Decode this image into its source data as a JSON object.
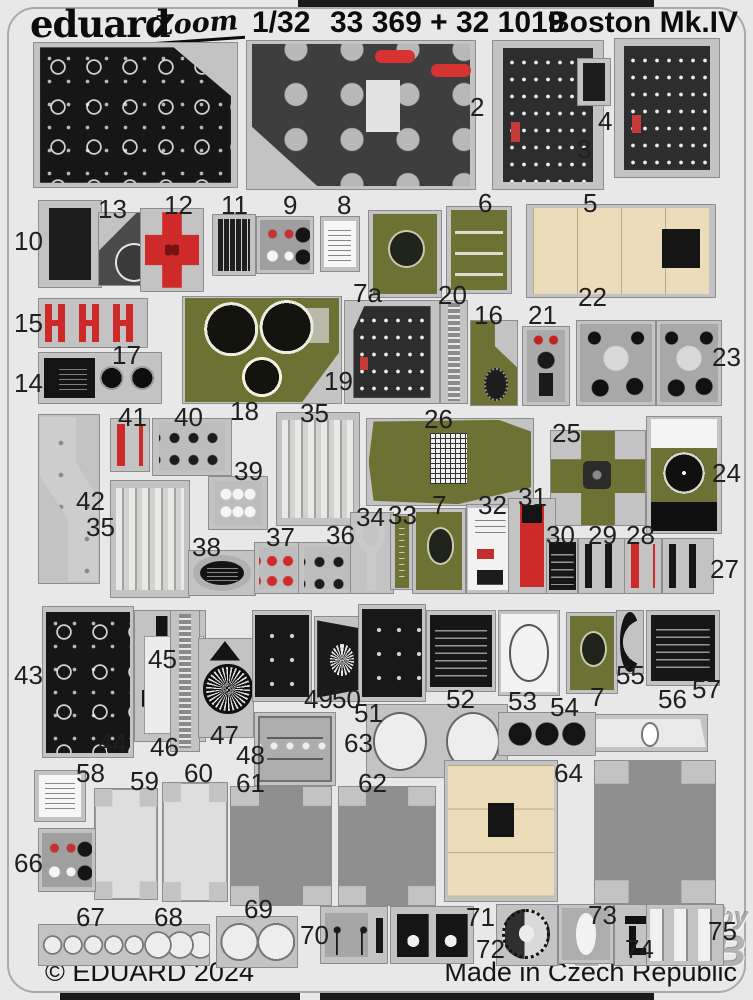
{
  "header": {
    "brand": "eduard",
    "series_logo": "Zoom",
    "scale": "1/32",
    "product_codes": "33 369 + 32 1019",
    "aircraft": "Boston Mk.IV"
  },
  "footer": {
    "copyright": "© EDUARD 2024",
    "made_in": "Made in Czech Republic"
  },
  "watermark": {
    "line1": "distributed by",
    "line2": "GLOW2B"
  },
  "colors": {
    "sheet_background": "#e8e8e8",
    "fret_metal": "#c3c3c3",
    "film_black": "#161616",
    "panel_dark": "#3e3e3e",
    "olive_drab": "#6d7134",
    "red_part": "#cf2a2a",
    "cream_part": "#ecdcba"
  },
  "parts": [
    {
      "label": "",
      "type": "film",
      "cls": "cut-tr",
      "x": 33,
      "y": 42,
      "w": 205,
      "h": 146
    },
    {
      "label": "",
      "type": "main-panel",
      "x": 246,
      "y": 40,
      "w": 230,
      "h": 150
    },
    {
      "label": "2",
      "lx": 470,
      "ly": 92,
      "type": "switch-panel",
      "x": 492,
      "y": 40,
      "w": 112,
      "h": 150
    },
    {
      "label": "3",
      "lx": 577,
      "ly": 134,
      "type": "plain-dark",
      "x": 577,
      "y": 58,
      "w": 34,
      "h": 48
    },
    {
      "label": "4",
      "lx": 598,
      "ly": 106,
      "type": "switch-panel",
      "x": 614,
      "y": 38,
      "w": 106,
      "h": 140
    },
    {
      "label": "10",
      "lx": 14,
      "ly": 226,
      "type": "plain-dark",
      "x": 38,
      "y": 200,
      "w": 64,
      "h": 88
    },
    {
      "label": "13",
      "lx": 98,
      "ly": 194,
      "type": "dial-wedge",
      "x": 98,
      "y": 212,
      "w": 70,
      "h": 74
    },
    {
      "label": "12",
      "lx": 164,
      "ly": 190,
      "type": "red-cross",
      "x": 140,
      "y": 208,
      "w": 64,
      "h": 84
    },
    {
      "label": "11",
      "lx": 221,
      "ly": 190,
      "type": "stripes-dark",
      "x": 212,
      "y": 214,
      "w": 44,
      "h": 62
    },
    {
      "label": "9",
      "lx": 283,
      "ly": 190,
      "type": "knob-panel",
      "x": 256,
      "y": 216,
      "w": 58,
      "h": 58
    },
    {
      "label": "8",
      "lx": 337,
      "ly": 190,
      "type": "white-placard",
      "x": 320,
      "y": 216,
      "w": 40,
      "h": 56
    },
    {
      "label": "7a",
      "lx": 353,
      "ly": 278,
      "type": "olive-dial",
      "x": 368,
      "y": 210,
      "w": 74,
      "h": 88
    },
    {
      "label": "6",
      "lx": 478,
      "ly": 188,
      "type": "olive-strips",
      "x": 446,
      "y": 206,
      "w": 66,
      "h": 88
    },
    {
      "label": "5",
      "lx": 583,
      "ly": 188,
      "type": "cream-box",
      "x": 526,
      "y": 204,
      "w": 190,
      "h": 94
    },
    {
      "label": "15",
      "lx": 14,
      "ly": 308,
      "type": "red-h",
      "x": 38,
      "y": 298,
      "w": 110,
      "h": 50
    },
    {
      "label": "17",
      "lx": 112,
      "ly": 340
    },
    {
      "label": "14",
      "lx": 14,
      "ly": 368,
      "type": "placard-grommets",
      "x": 38,
      "y": 352,
      "w": 124,
      "h": 52
    },
    {
      "label": "18",
      "lx": 230,
      "ly": 396,
      "type": "olive-gauges",
      "x": 182,
      "y": 296,
      "w": 160,
      "h": 108
    },
    {
      "label": "19",
      "lx": 324,
      "ly": 366,
      "type": "switch-panel",
      "cls": "cut-tl",
      "x": 344,
      "y": 300,
      "w": 96,
      "h": 104
    },
    {
      "label": "20",
      "lx": 438,
      "ly": 280,
      "type": "strip-ticks",
      "x": 440,
      "y": 300,
      "w": 28,
      "h": 104
    },
    {
      "label": "16",
      "lx": 474,
      "ly": 300,
      "type": "olive-knob",
      "x": 470,
      "y": 320,
      "w": 48,
      "h": 86
    },
    {
      "label": "21",
      "lx": 528,
      "ly": 300,
      "type": "gray-controls",
      "x": 522,
      "y": 326,
      "w": 48,
      "h": 80
    },
    {
      "label": "22",
      "lx": 578,
      "ly": 282,
      "type": "gray-knobs",
      "x": 576,
      "y": 320,
      "w": 80,
      "h": 86
    },
    {
      "label": "23",
      "lx": 712,
      "ly": 342,
      "type": "gray-knobs",
      "x": 656,
      "y": 320,
      "w": 66,
      "h": 86
    },
    {
      "label": "42",
      "lx": 76,
      "ly": 486,
      "type": "bracket",
      "x": 38,
      "y": 414,
      "w": 62,
      "h": 170
    },
    {
      "label": "41",
      "lx": 118,
      "ly": 402,
      "type": "strip-red",
      "x": 110,
      "y": 418,
      "w": 40,
      "h": 54
    },
    {
      "label": "40",
      "lx": 174,
      "ly": 402,
      "type": "strip-blackdots",
      "x": 152,
      "y": 418,
      "w": 80,
      "h": 58
    },
    {
      "label": "35",
      "lx": 300,
      "ly": 398,
      "type": "bullets",
      "x": 276,
      "y": 412,
      "w": 84,
      "h": 114
    },
    {
      "label": "39",
      "lx": 234,
      "ly": 456,
      "type": "dots-white",
      "x": 208,
      "y": 476,
      "w": 60,
      "h": 54
    },
    {
      "label": "35",
      "lx": 86,
      "ly": 512,
      "type": "bullets",
      "x": 110,
      "y": 480,
      "w": 80,
      "h": 118
    },
    {
      "label": "26",
      "lx": 424,
      "ly": 404,
      "type": "olive-grid",
      "x": 366,
      "y": 418,
      "w": 168,
      "h": 88
    },
    {
      "label": "25",
      "lx": 552,
      "ly": 418,
      "type": "olive-cross",
      "x": 550,
      "y": 430,
      "w": 96,
      "h": 96
    },
    {
      "label": "24",
      "lx": 712,
      "ly": 458,
      "type": "compass",
      "x": 646,
      "y": 416,
      "w": 76,
      "h": 118
    },
    {
      "label": "38",
      "lx": 192,
      "ly": 532,
      "type": "oval-placard",
      "x": 188,
      "y": 550,
      "w": 68,
      "h": 46
    },
    {
      "label": "37",
      "lx": 266,
      "ly": 522,
      "type": "strip-reddots",
      "x": 254,
      "y": 542,
      "w": 48,
      "h": 52
    },
    {
      "label": "36",
      "lx": 326,
      "ly": 520,
      "type": "strip-blackdots",
      "x": 298,
      "y": 542,
      "w": 68,
      "h": 52
    },
    {
      "label": "34",
      "lx": 356,
      "ly": 502,
      "type": "hook",
      "x": 350,
      "y": 512,
      "w": 44,
      "h": 82
    },
    {
      "label": "33",
      "lx": 388,
      "ly": 500,
      "type": "olive-strip-narrow",
      "x": 390,
      "y": 514,
      "w": 24,
      "h": 76
    },
    {
      "label": "7",
      "lx": 432,
      "ly": 490,
      "type": "olive-dial",
      "x": 412,
      "y": 508,
      "w": 54,
      "h": 86
    },
    {
      "label": "32",
      "lx": 478,
      "ly": 490,
      "type": "white-panelled",
      "x": 466,
      "y": 504,
      "w": 48,
      "h": 90
    },
    {
      "label": "31",
      "lx": 518,
      "ly": 482,
      "type": "red-tab",
      "x": 508,
      "y": 498,
      "w": 48,
      "h": 96
    },
    {
      "label": "30",
      "lx": 546,
      "ly": 520,
      "type": "black-placard",
      "x": 546,
      "y": 538,
      "w": 32,
      "h": 56
    },
    {
      "label": "29",
      "lx": 588,
      "ly": 520,
      "type": "dumbbells",
      "x": 578,
      "y": 538,
      "w": 54,
      "h": 56
    },
    {
      "label": "28",
      "lx": 626,
      "ly": 520,
      "type": "strip-red",
      "x": 624,
      "y": 538,
      "w": 38,
      "h": 56
    },
    {
      "label": "27",
      "lx": 710,
      "ly": 554,
      "type": "dumbbells",
      "x": 662,
      "y": 538,
      "w": 52,
      "h": 56
    },
    {
      "label": "43",
      "lx": 14,
      "ly": 660,
      "type": "film",
      "x": 42,
      "y": 606,
      "w": 92,
      "h": 152
    },
    {
      "label": "44",
      "lx": 98,
      "ly": 728,
      "type": "black-levers",
      "x": 134,
      "y": 610,
      "w": 72,
      "h": 132
    },
    {
      "label": "45",
      "lx": 148,
      "ly": 644,
      "type": "white-island",
      "x": 144,
      "y": 636,
      "w": 60,
      "h": 98
    },
    {
      "label": "46",
      "lx": 150,
      "ly": 732,
      "type": "strip-ticks",
      "x": 170,
      "y": 610,
      "w": 30,
      "h": 142
    },
    {
      "label": "47",
      "lx": 210,
      "ly": 720,
      "type": "rosette",
      "x": 198,
      "y": 638,
      "w": 56,
      "h": 100
    },
    {
      "label": "49",
      "lx": 304,
      "ly": 684,
      "type": "black-panel-dots",
      "x": 252,
      "y": 610,
      "w": 60,
      "h": 92
    },
    {
      "label": "50",
      "lx": 332,
      "ly": 684,
      "type": "black-dial",
      "x": 314,
      "y": 616,
      "w": 56,
      "h": 86
    },
    {
      "label": "51",
      "lx": 354,
      "ly": 698,
      "type": "black-panel-dots",
      "x": 358,
      "y": 604,
      "w": 68,
      "h": 98
    },
    {
      "label": "52",
      "lx": 446,
      "ly": 684,
      "type": "black-placard",
      "x": 426,
      "y": 610,
      "w": 70,
      "h": 82
    },
    {
      "label": "53",
      "lx": 508,
      "ly": 686,
      "type": "white-circle-panel",
      "x": 498,
      "y": 610,
      "w": 62,
      "h": 86
    },
    {
      "label": "54",
      "lx": 550,
      "ly": 692
    },
    {
      "label": "7",
      "lx": 590,
      "ly": 682,
      "type": "olive-dial",
      "x": 566,
      "y": 612,
      "w": 52,
      "h": 82
    },
    {
      "label": "55",
      "lx": 616,
      "ly": 660,
      "type": "crescent",
      "x": 616,
      "y": 610,
      "w": 28,
      "h": 64
    },
    {
      "label": "57",
      "lx": 692,
      "ly": 674,
      "type": "black-placard",
      "x": 646,
      "y": 610,
      "w": 74,
      "h": 76
    },
    {
      "label": "56",
      "lx": 658,
      "ly": 684,
      "type": "white-trapezoid",
      "x": 586,
      "y": 714,
      "w": 122,
      "h": 38
    },
    {
      "label": "63",
      "lx": 344,
      "ly": 728,
      "type": "binoculars",
      "x": 366,
      "y": 704,
      "w": 142,
      "h": 74
    },
    {
      "label": "",
      "type": "dots-black",
      "x": 498,
      "y": 712,
      "w": 98,
      "h": 44
    },
    {
      "label": "48",
      "lx": 236,
      "ly": 740,
      "type": "radio-face",
      "x": 254,
      "y": 712,
      "w": 82,
      "h": 74
    },
    {
      "label": "58",
      "lx": 76,
      "ly": 758,
      "type": "white-placard",
      "x": 34,
      "y": 770,
      "w": 52,
      "h": 52
    },
    {
      "label": "59",
      "lx": 130,
      "ly": 766,
      "type": "box-cross-light",
      "x": 94,
      "y": 788,
      "w": 64,
      "h": 112
    },
    {
      "label": "60",
      "lx": 184,
      "ly": 758,
      "type": "box-cross-light",
      "x": 162,
      "y": 782,
      "w": 66,
      "h": 120
    },
    {
      "label": "61",
      "lx": 236,
      "ly": 768,
      "type": "box-cross-dark",
      "x": 230,
      "y": 786,
      "w": 102,
      "h": 120
    },
    {
      "label": "62",
      "lx": 358,
      "ly": 768,
      "type": "box-cross-dark",
      "x": 338,
      "y": 786,
      "w": 98,
      "h": 120
    },
    {
      "label": "64",
      "lx": 554,
      "ly": 758,
      "type": "cream-box2",
      "x": 444,
      "y": 760,
      "w": 114,
      "h": 142
    },
    {
      "label": "",
      "type": "box-cross-dark",
      "x": 594,
      "y": 760,
      "w": 122,
      "h": 144
    },
    {
      "label": "66",
      "lx": 14,
      "ly": 848,
      "type": "knob-panel",
      "x": 38,
      "y": 828,
      "w": 58,
      "h": 64
    },
    {
      "label": "67",
      "lx": 76,
      "ly": 902,
      "type": "circles-strip",
      "x": 38,
      "y": 924,
      "w": 172,
      "h": 42
    },
    {
      "label": "68",
      "lx": 154,
      "ly": 902
    },
    {
      "label": "69",
      "lx": 244,
      "ly": 894,
      "type": "circles-big",
      "x": 216,
      "y": 916,
      "w": 82,
      "h": 52
    },
    {
      "label": "70",
      "lx": 300,
      "ly": 920,
      "type": "compass-flowers",
      "x": 320,
      "y": 906,
      "w": 68,
      "h": 58
    },
    {
      "label": "71",
      "lx": 466,
      "ly": 902,
      "type": "black-placard-pair",
      "x": 390,
      "y": 906,
      "w": 84,
      "h": 58
    },
    {
      "label": "72",
      "lx": 476,
      "ly": 934,
      "type": "compass-ring",
      "x": 496,
      "y": 904,
      "w": 62,
      "h": 62
    },
    {
      "label": "73",
      "lx": 588,
      "ly": 900,
      "type": "oval-white",
      "x": 558,
      "y": 904,
      "w": 56,
      "h": 60
    },
    {
      "label": "74",
      "lx": 625,
      "ly": 934,
      "type": "dark-bits",
      "x": 614,
      "y": 904,
      "w": 50,
      "h": 62
    },
    {
      "label": "75",
      "lx": 708,
      "ly": 916,
      "type": "white-strips",
      "x": 646,
      "y": 904,
      "w": 78,
      "h": 62
    }
  ]
}
